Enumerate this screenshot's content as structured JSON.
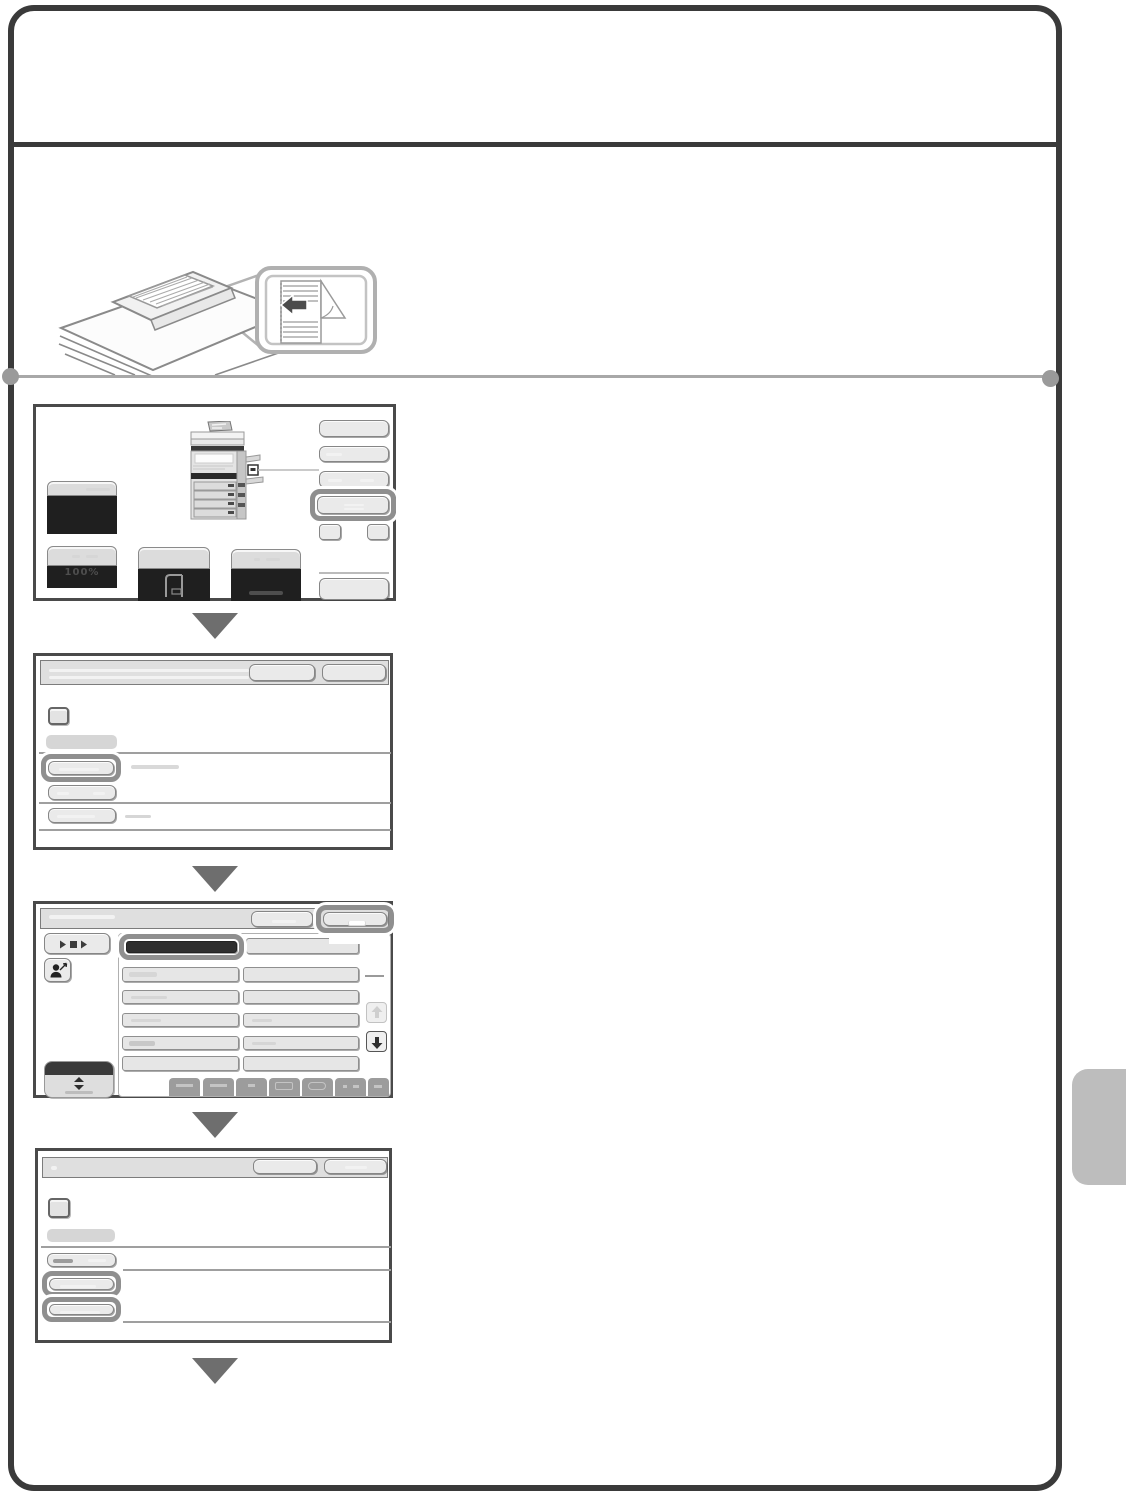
{
  "page": {
    "background": "#ffffff",
    "frame_color": "#3a3a3a",
    "step_rule_color": "#a8a8a8",
    "side_tab_color": "#bdbdbd",
    "highlight_ring_color": "#8f8f8f",
    "step_arrow_color": "#6e6e6e",
    "step_count": "4"
  },
  "illustration": {
    "subject": "document-feeder-with-original",
    "callout_arrow_direction": "left"
  },
  "screens": {
    "copy_base": {
      "zoom_ratio": "100%"
    }
  }
}
